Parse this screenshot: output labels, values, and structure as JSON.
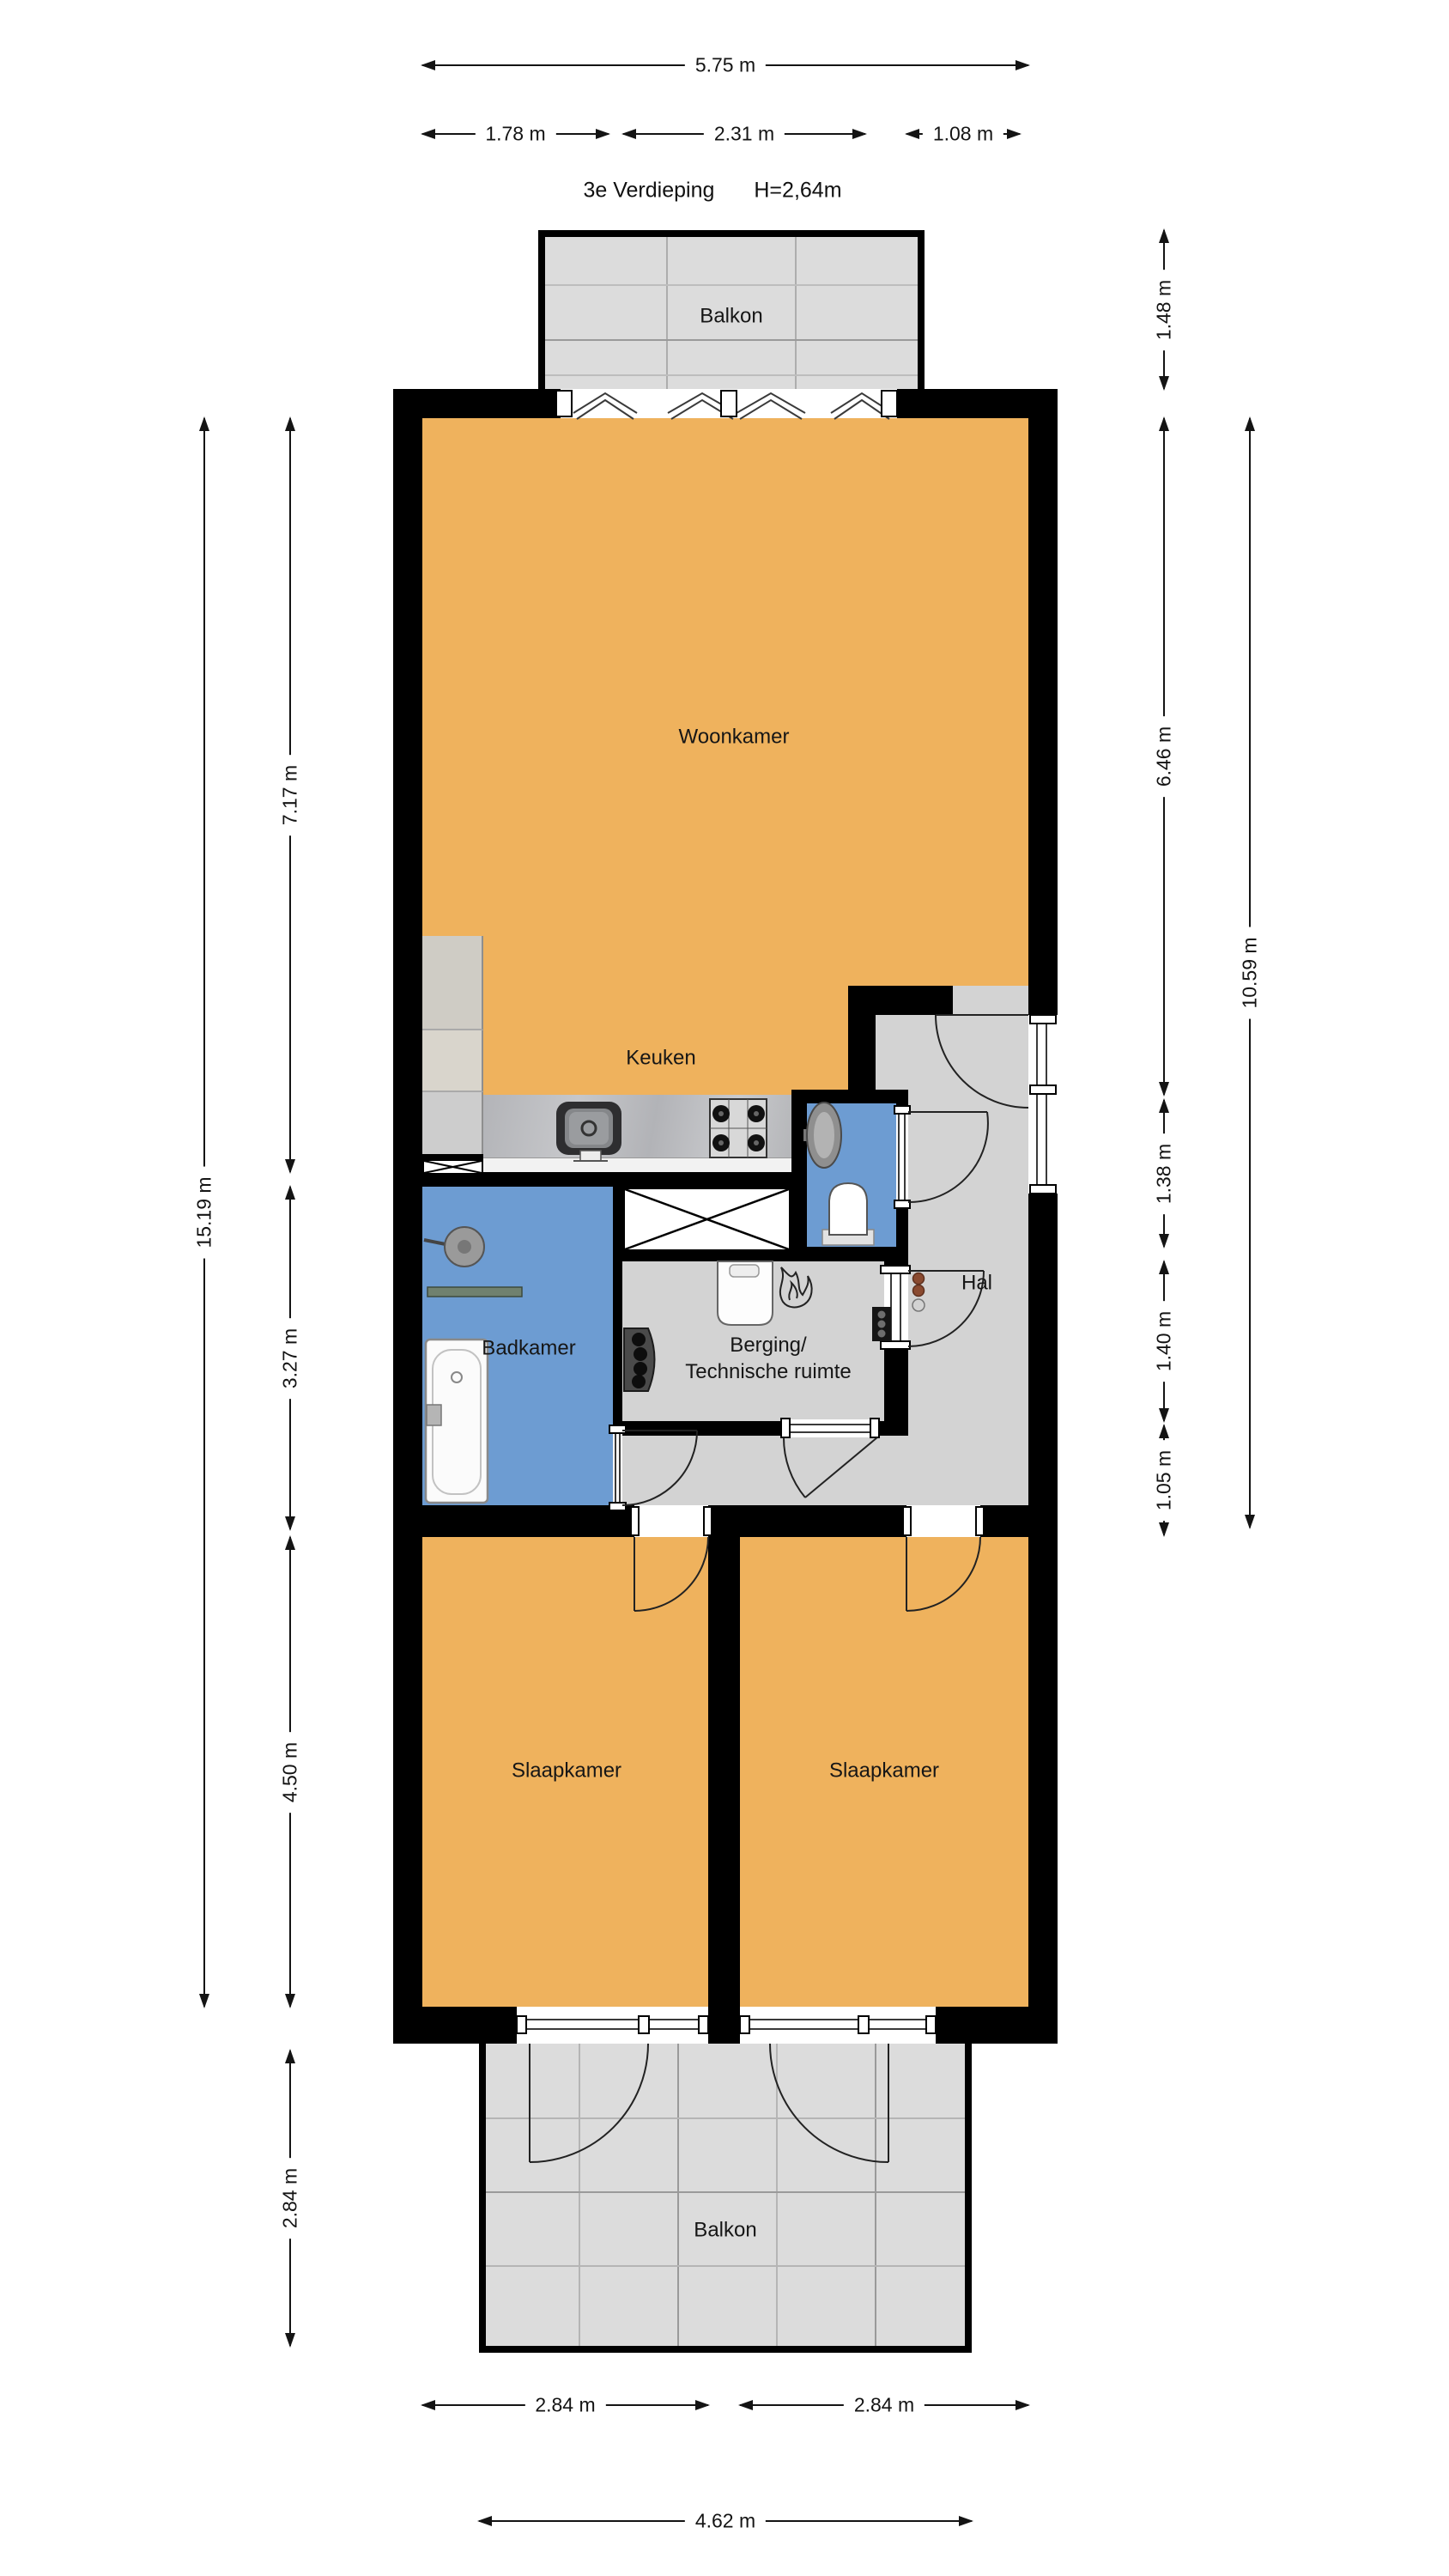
{
  "title": {
    "floor": "3e Verdieping",
    "height": "H=2,64m"
  },
  "rooms": {
    "balkon_top": "Balkon",
    "woonkamer": "Woonkamer",
    "keuken": "Keuken",
    "badkamer": "Badkamer",
    "berging_line1": "Berging/",
    "berging_line2": "Technische ruimte",
    "hal": "Hal",
    "slaapkamer_left": "Slaapkamer",
    "slaapkamer_right": "Slaapkamer",
    "balkon_bottom": "Balkon"
  },
  "dimensions": {
    "top_total": "5.75 m",
    "top_segments": [
      "1.78 m",
      "2.31 m",
      "1.08 m"
    ],
    "left": {
      "total": "15.19 m",
      "woonkamer": "7.17 m",
      "badkamer": "3.27 m",
      "slaapkamer": "4.50 m",
      "balkon": "2.84 m"
    },
    "right": {
      "balkon": "1.48 m",
      "woonkamer": "6.46 m",
      "wc": "1.38 m",
      "hal": "1.40 m",
      "berging": "1.05 m",
      "total": "10.59 m"
    },
    "bottom": {
      "slaapkamer_left": "2.84 m",
      "slaapkamer_right": "2.84 m",
      "balkon": "4.62 m"
    }
  },
  "colors": {
    "wall": "#000000",
    "floor_living": "#EFB25D",
    "floor_wet": "#6D9CD2",
    "floor_circulation": "#D3D3D3",
    "floor_balcony": "#DCDCDC",
    "counter": "#B7B8BB"
  }
}
